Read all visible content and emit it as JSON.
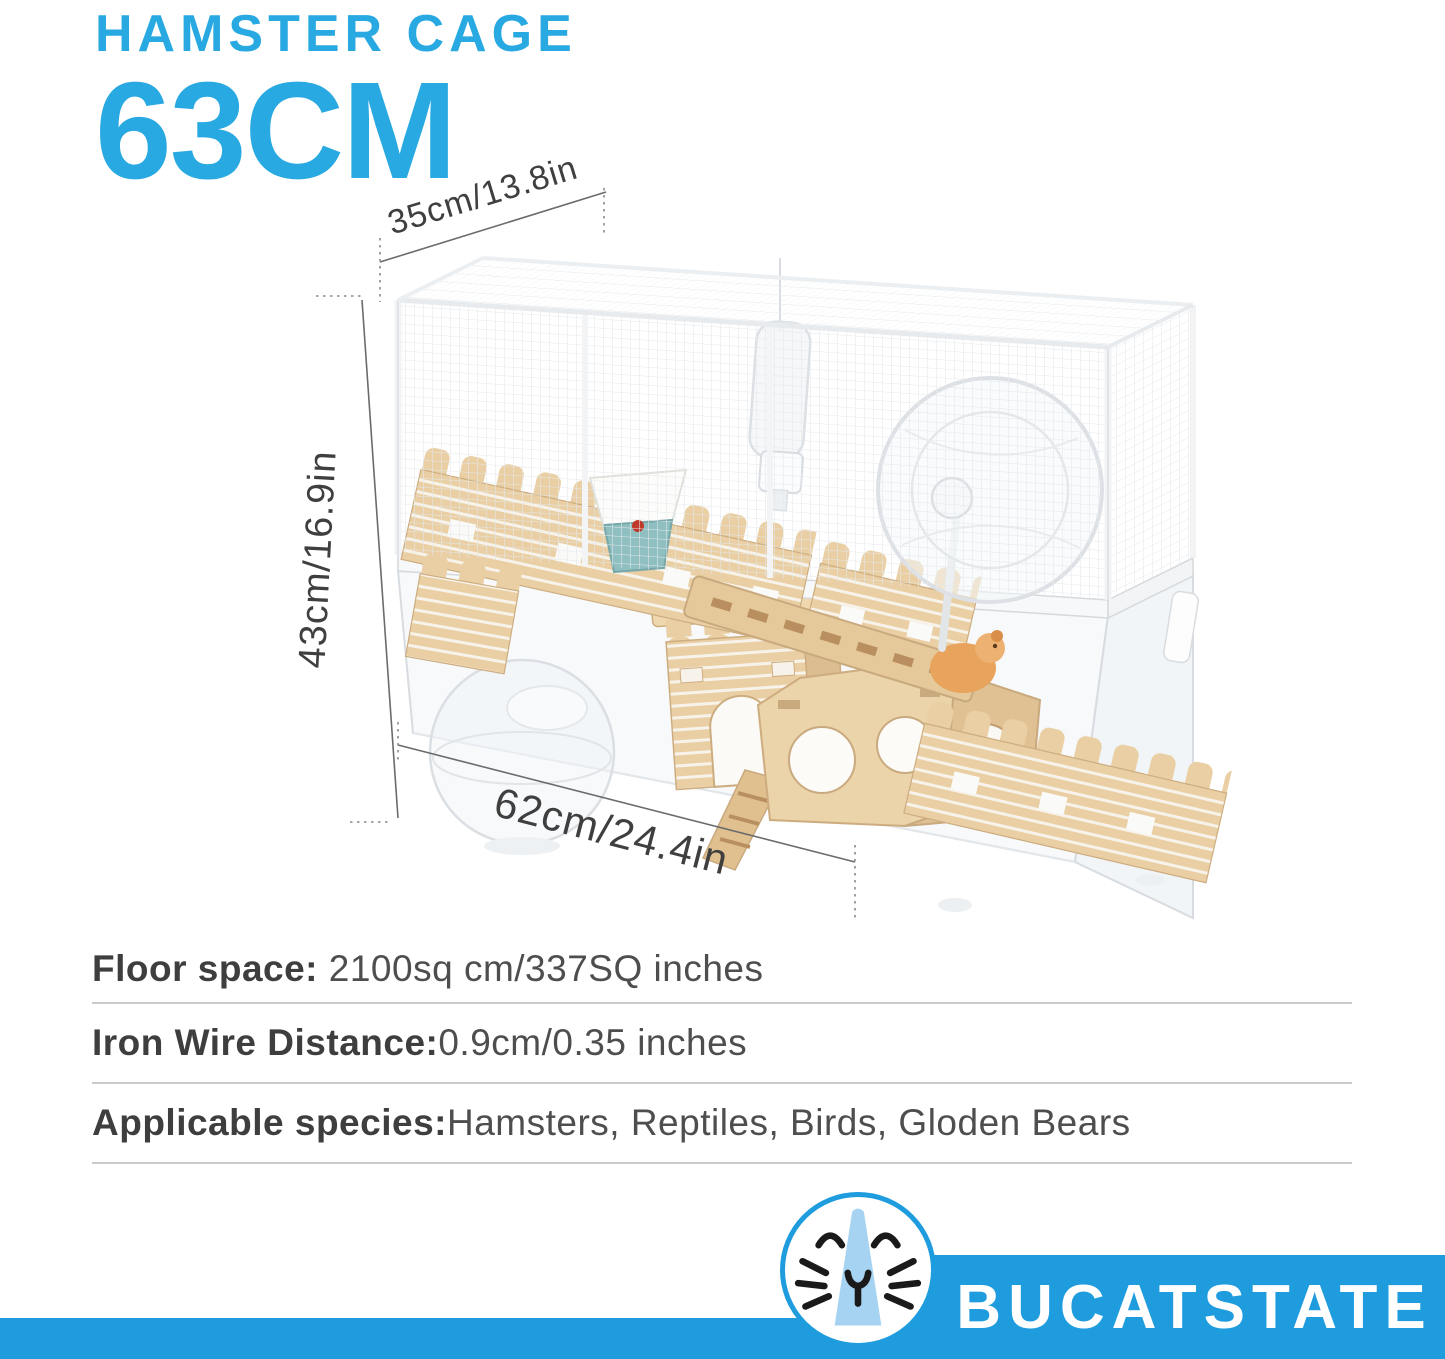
{
  "title": {
    "line1": "HAMSTER CAGE",
    "line2": "63CM"
  },
  "diagram": {
    "dim_width_top": "35cm/13.8in",
    "dim_height": "43cm/16.9in",
    "dim_depth": "62cm/24.4in"
  },
  "specs": [
    {
      "label": "Floor space:",
      "value": " 2100sq cm/337SQ inches"
    },
    {
      "label": "Iron Wire Distance:",
      "value": "0.9cm/0.35 inches"
    },
    {
      "label": "Applicable species:",
      "value": "Hamsters, Reptiles, Birds, Gloden Bears"
    }
  ],
  "brand": {
    "wordmark": "BUCATSTATE",
    "logo_icon": "hamster-face-icon"
  },
  "colors": {
    "accent_blue": "#29A9E1",
    "band_blue": "#1E9CDE",
    "logo_light_blue": "#A5D3F1",
    "text_dark": "#3E3E3E",
    "wood": "#E9CFA3",
    "dim_line": "#6B6B6B"
  }
}
